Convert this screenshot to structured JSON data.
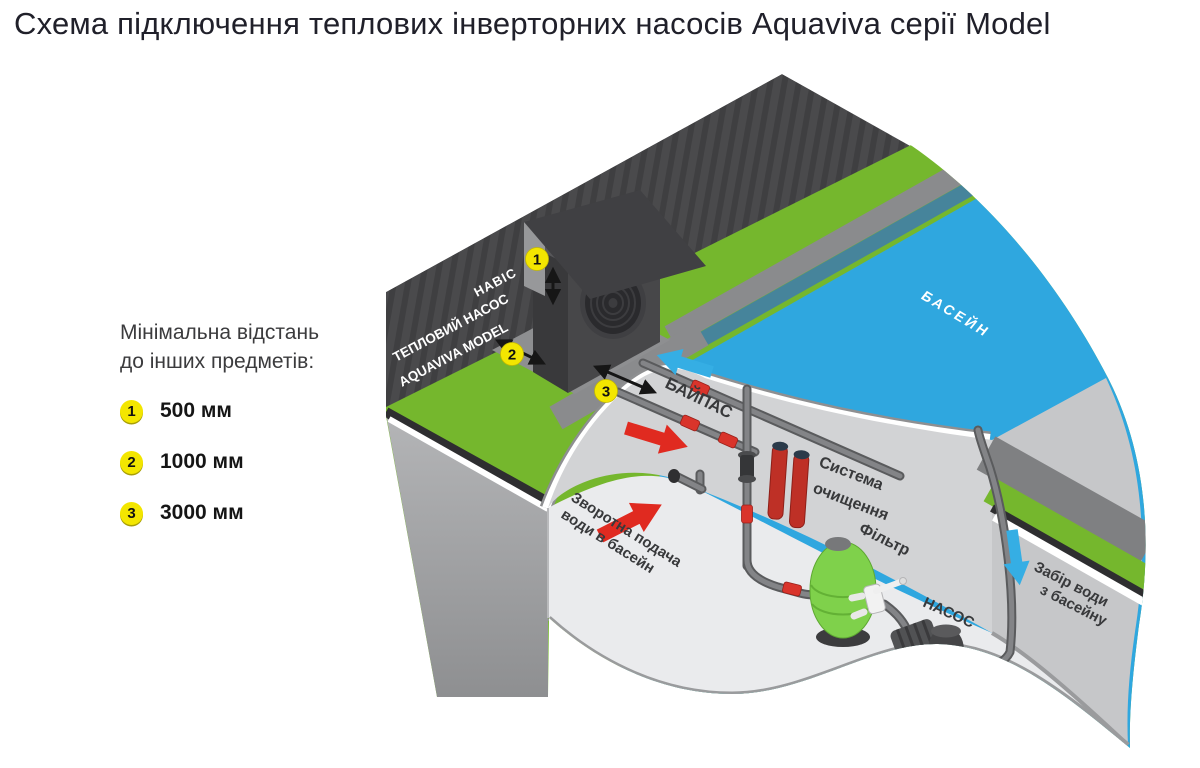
{
  "title": "Схема підключення теплових інверторних насосів Aquaviva серії Model",
  "legend": {
    "heading_line1": "Мінімальна відстань",
    "heading_line2": "до інших предметів:",
    "items": [
      {
        "num": "1",
        "label": "500 мм"
      },
      {
        "num": "2",
        "label": "1000 мм"
      },
      {
        "num": "3",
        "label": "3000 мм"
      }
    ]
  },
  "diagram": {
    "canopy_label": "НАВІС",
    "heat_pump_line1": "ТЕПЛОВИЙ НАСОС",
    "heat_pump_line2": "AQUAVIVA MODEL",
    "pool_label": "БАСЕЙН",
    "bypass_label": "БАЙПАС",
    "cleaning_line1": "Система",
    "cleaning_line2": "очищення",
    "filter_label": "Фільтр",
    "pump_label": "НАСОС",
    "return_line1": "Зворотна подача",
    "return_line2": "води в басейн",
    "intake_line1": "Забір води",
    "intake_line2": "з басейну",
    "markers": [
      "1",
      "2",
      "3"
    ]
  },
  "colors": {
    "wall": "#4a4a4c",
    "wall_stripe": "#3f3f41",
    "grass": "#75b72d",
    "deck": "#8a8b8d",
    "pool": "#2fa7df",
    "pool_edge_teal": "#46849b",
    "soil": "#2e2e30",
    "block_face": "#a5a6a8",
    "room_wall": "#d2d3d5",
    "floor": "#eaebed",
    "right_wall": "#c6c7c9",
    "pipe": "#838487",
    "valve_red": "#d9342b",
    "arrow_red": "#e02a20",
    "arrow_blue": "#35aee4",
    "marker_yellow": "#f3e600",
    "filter_green": "#7fd14b",
    "cylinder_red": "#be3026",
    "equipment_dark": "#474749"
  }
}
